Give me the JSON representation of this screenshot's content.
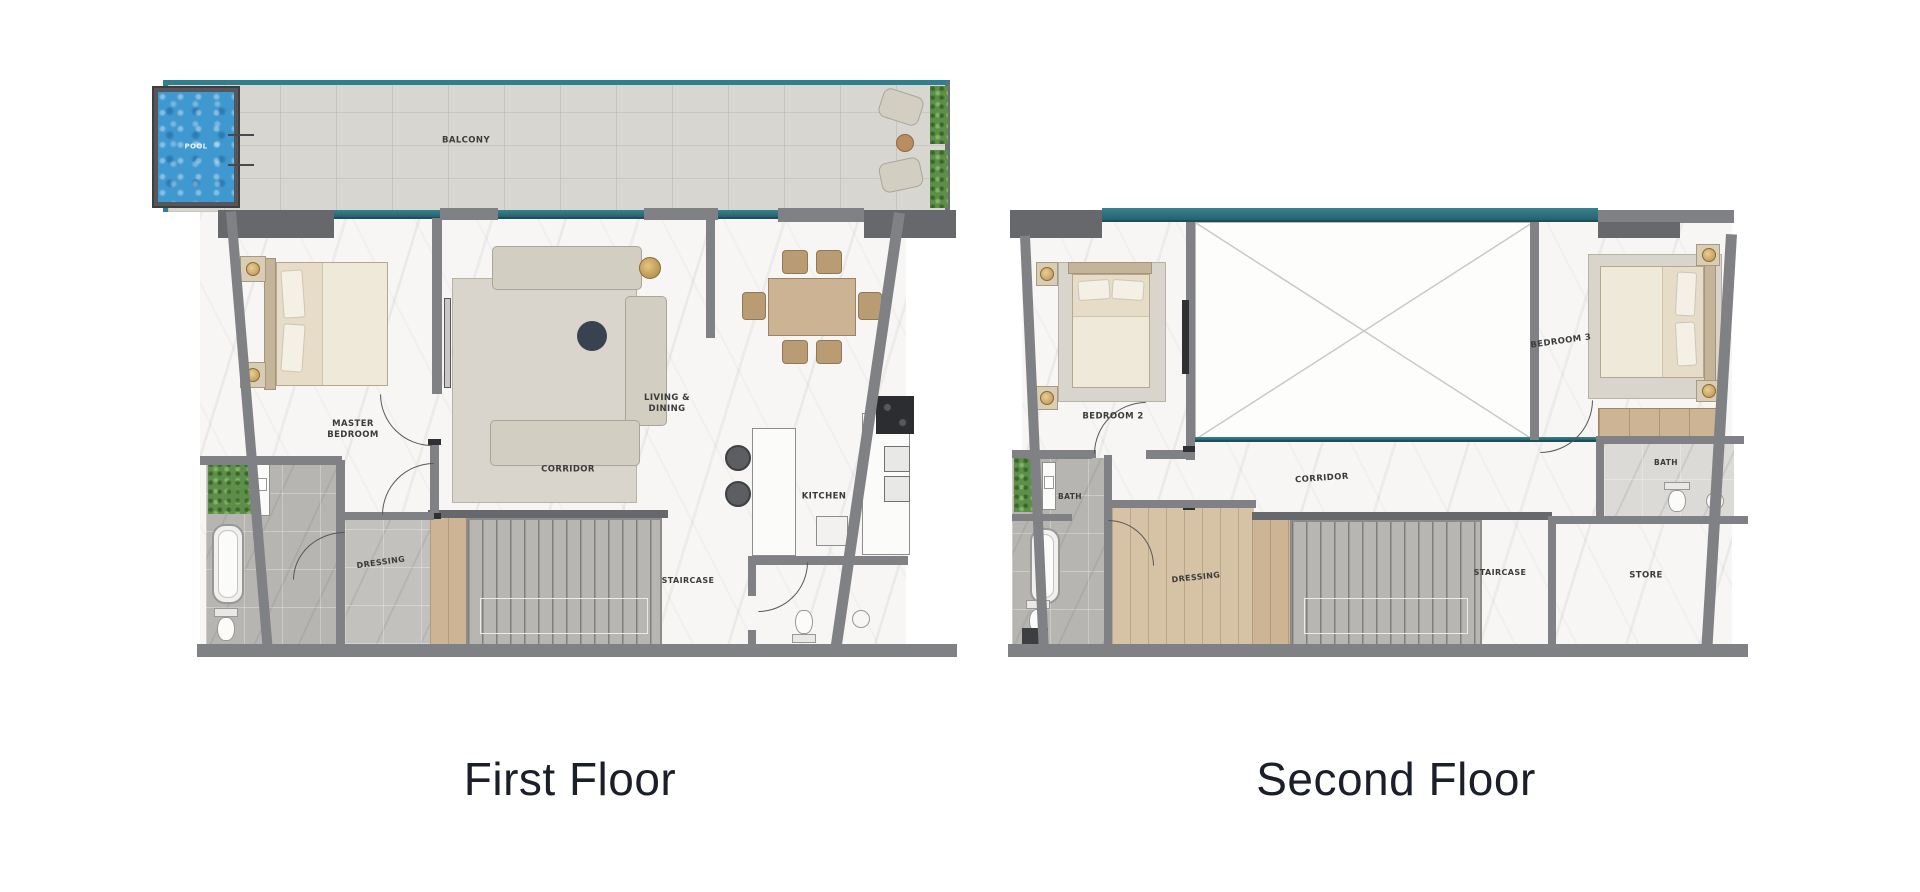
{
  "titles": {
    "first_floor": "First Floor",
    "second_floor": "Second Floor"
  },
  "first_floor": {
    "labels": {
      "pool": "POOL",
      "balcony": "BALCONY",
      "master_bedroom": "MASTER BEDROOM",
      "living_dining": "LIVING & DINING",
      "corridor": "CORRIDOR",
      "kitchen": "KITCHEN",
      "dressing": "DRESSING",
      "staircase": "STAIRCASE"
    }
  },
  "second_floor": {
    "labels": {
      "bedroom_2": "BEDROOM 2",
      "bedroom_3": "BEDROOM 3",
      "bath_left": "BATH",
      "corridor": "CORRIDOR",
      "dressing": "DRESSING",
      "staircase": "STAIRCASE",
      "store": "STORE",
      "bath_right": "BATH"
    }
  },
  "colors": {
    "teal_glass": "#2f7f8e",
    "pool_water": "#3f98cf",
    "plant_green": "#5d8f4a",
    "wall_grey": "#7f8184",
    "deck_grey": "#d8d6d1",
    "wood": "#ccb494",
    "title_text": "#1b1f2a"
  }
}
